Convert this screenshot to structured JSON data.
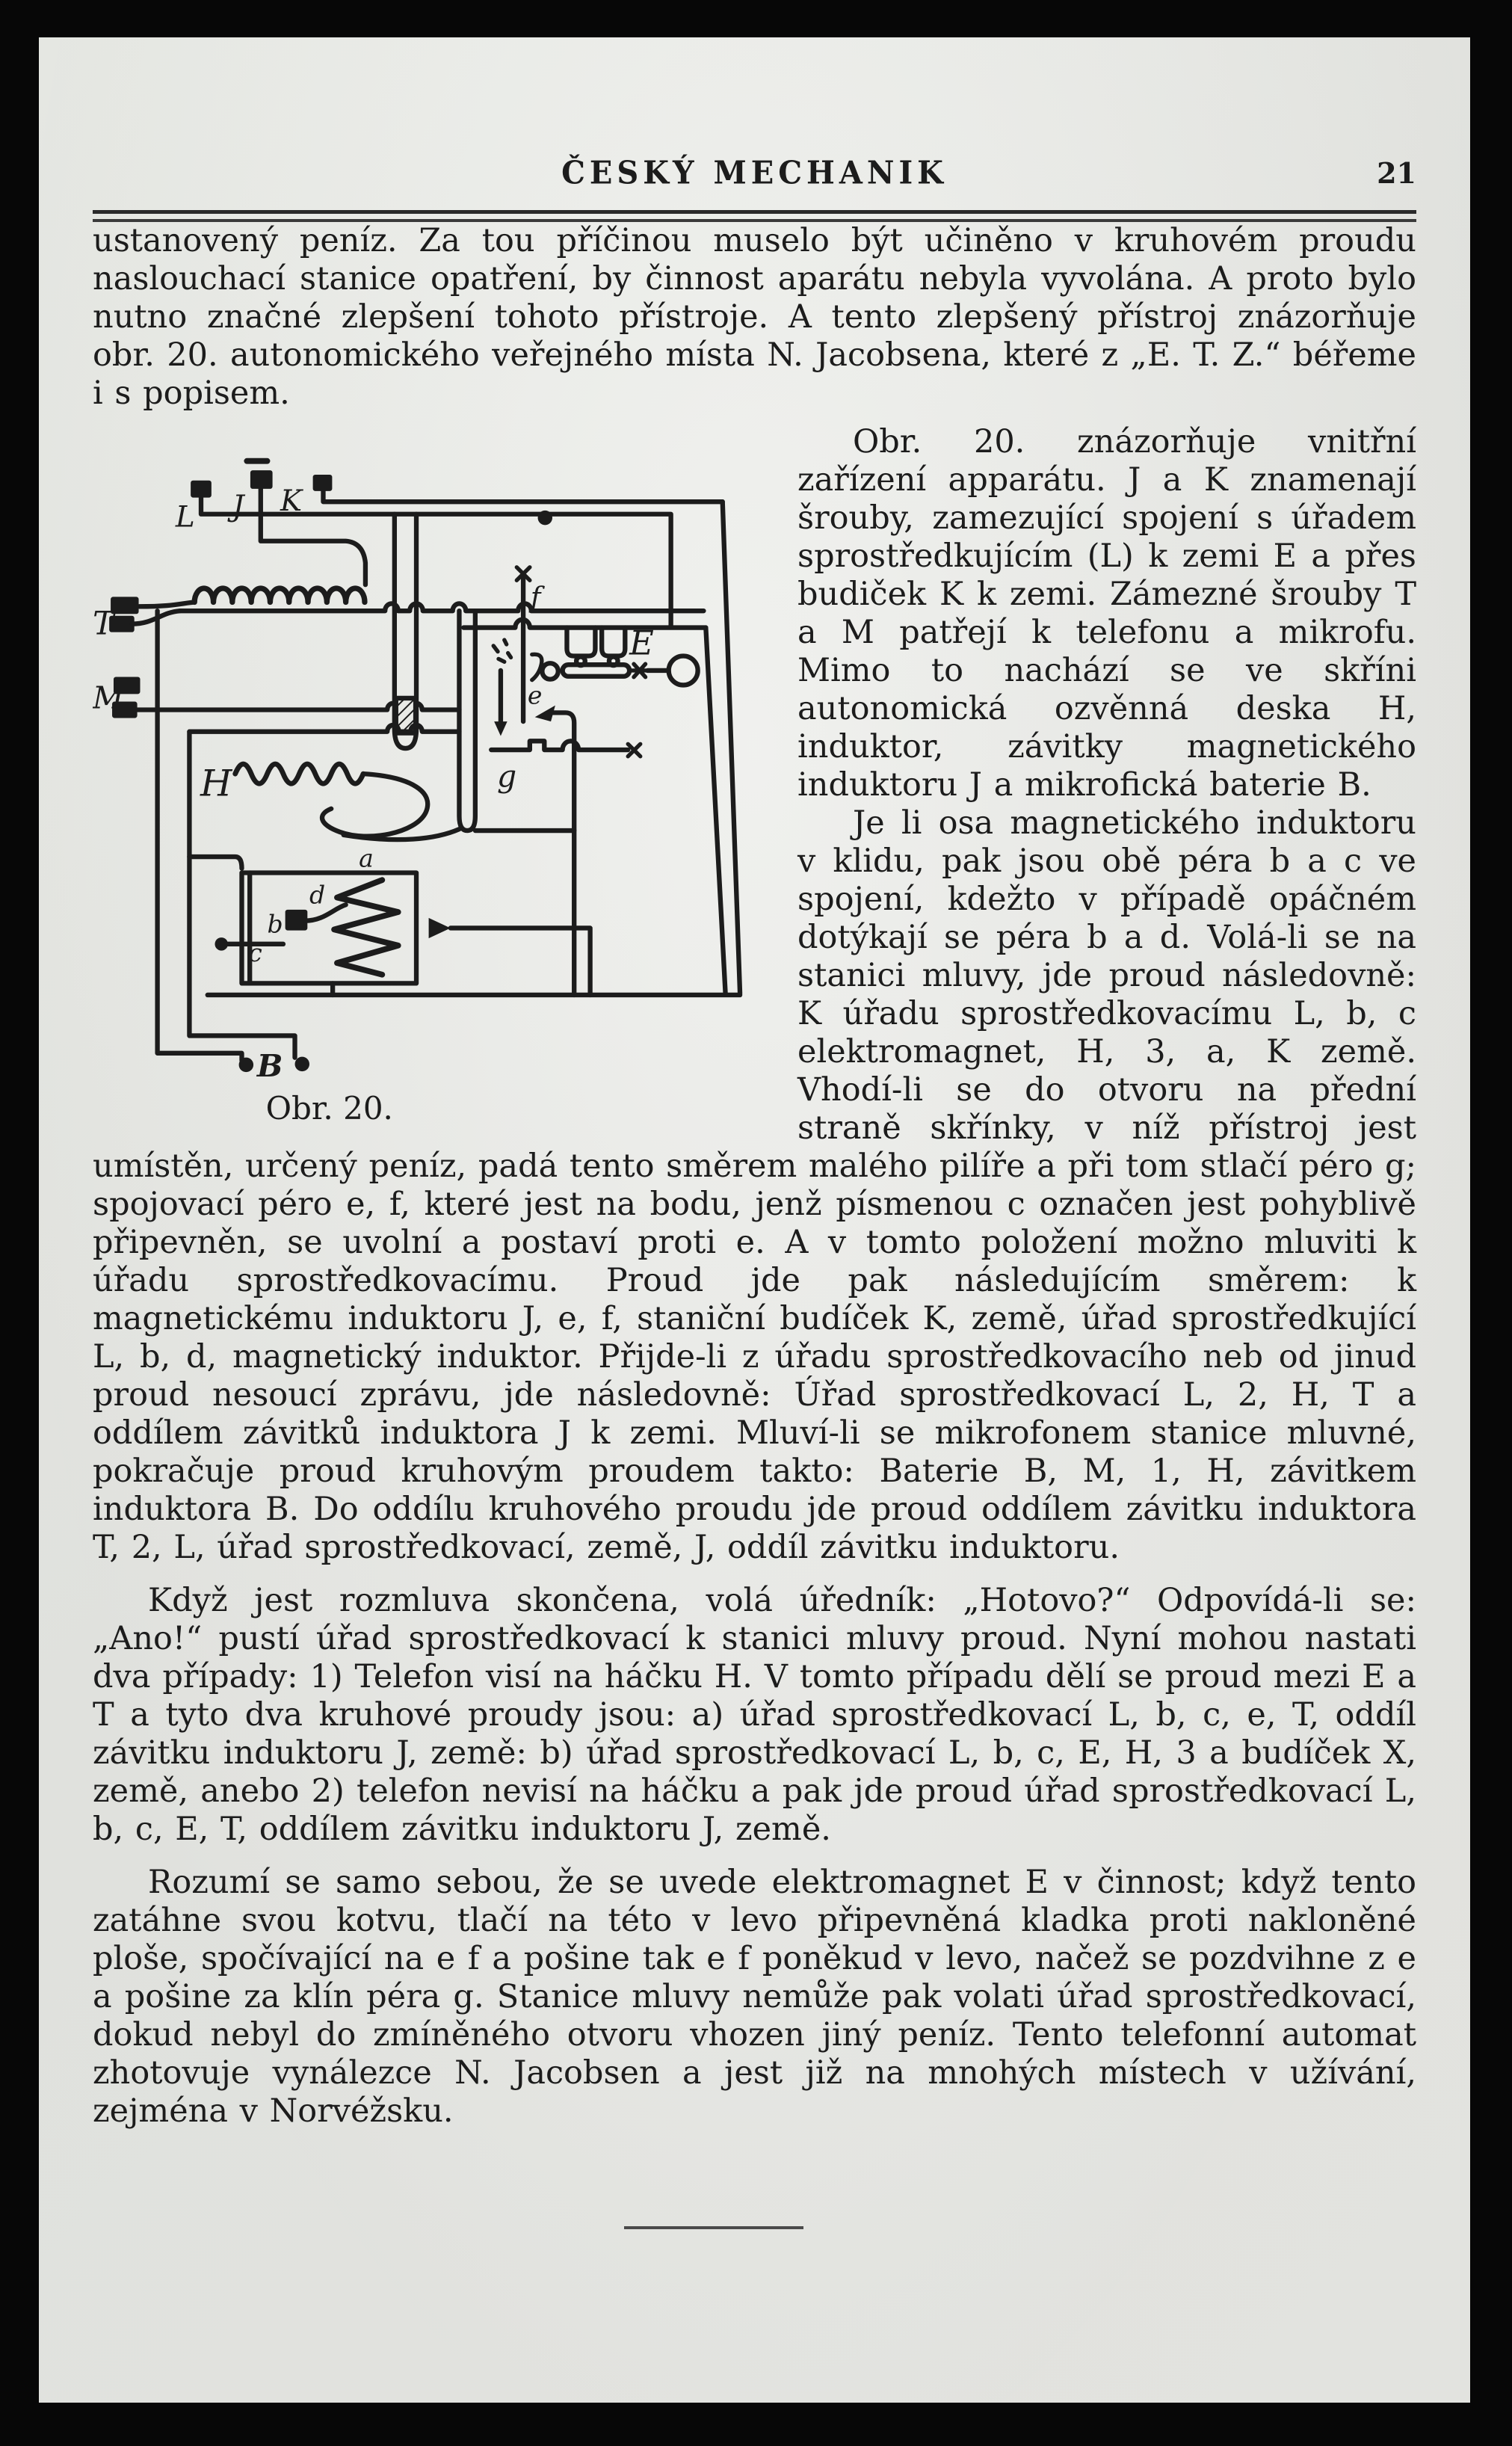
{
  "page": {
    "header": {
      "title": "ČESKÝ MECHANIK",
      "page_number": "21"
    },
    "colors": {
      "ink": "#1c1c1c",
      "paper": "#e9eae6",
      "border": "#070707"
    },
    "paragraphs": {
      "p1": "ustanovený peníz. Za tou příčinou muselo být učiněno v kruhovém proudu naslouchací stanice opatření, by činnost aparátu nebyla vyvolána. A proto bylo nutno značné zlepšení tohoto přístroje. A tento zlepšený přístroj znázorňuje obr. 20. autonomického veřejného místa N. Jacobsena, které z „E. T. Z.“ béřeme i s popisem.",
      "p2": "Obr. 20. znázorňuje vnitřní zařízení apparátu. J a K znamenají šrouby, zamezující spojení s úřadem sprostředkujícím (L) k zemi E a přes budiček K k zemi. Zámezné šrouby T a M patřejí k telefonu a mikrofu. Mimo to nachází se ve skříni autonomická ozvěnná deska H, induktor, závitky magnetického induktoru J a mikrofická baterie B.",
      "p3": "Je li osa magnetického induktoru v klidu, pak jsou obě péra b a c ve spojení, kdežto v případě opáčném dotýkají se péra b a d. Volá-li se na stanici mluvy, jde proud následovně: K úřadu sprostředkovacímu L, b, c elektromagnet, H, 3, a, K země. Vhodí-li se do otvoru na přední straně skřínky, v níž přístroj jest umístěn, určený peníz, padá tento směrem malého pilíře a při tom stlačí péro g; spojovací péro e, f, které jest na bodu, jenž písmenou c označen jest pohyblivě připevněn, se uvolní a postaví proti e. A v tomto položení možno mluviti k úřadu sprostředkovacímu. Proud jde pak následujícím směrem: k magnetickému induktoru J, e, f, staniční budíček K, země, úřad sprostředkující L, b, d, magnetický induktor. Přijde-li z úřadu sprostředkovacího neb od jinud proud nesoucí zprávu, jde následovně: Úřad sprostředkovací L, 2, H, T a oddílem závitků induktora J k zemi. Mluví-li se mikrofonem stanice mluvné, pokračuje proud kruhovým proudem takto: Baterie B, M, 1, H, závitkem induktora B. Do oddílu kruhového proudu jde proud oddílem závitku induktora T, 2, L, úřad sprostředkovací, země, J, oddíl závitku induktoru.",
      "p4": "Když jest rozmluva skončena, volá úředník: „Hotovo?“ Odpovídá-li se: „Ano!“ pustí úřad sprostředkovací k stanici mluvy proud. Nyní mohou nastati dva případy: 1) Telefon visí na háčku H. V tomto případu dělí se proud mezi E a T a tyto dva kruhové proudy jsou: a) úřad sprostředkovací L, b, c, e, T, oddíl závitku induktoru J, země: b) úřad sprostředkovací L, b, c, E, H, 3 a budíček X, země, anebo 2) telefon nevisí na háčku a pak jde proud úřad sprostředkovací L, b, c, E, T, oddílem závitku induktoru J, země.",
      "p5": "Rozumí se samo sebou, že se uvede elektromagnet E v činnost; když tento zatáhne svou kotvu, tlačí na této v levo připevněná kladka proti nakloněné ploše, spočívající na e f a pošine tak e f poněkud v levo, načež se pozdvihne z e a pošine za klín péra g. Stanice mluvy nemůže pak volati úřad sprostředkovací, dokud nebyl do zmíněného otvoru vhozen jiný peníz. Tento telefonní automat zhotovuje vynálezce N. Jacobsen a jest již na mnohých místech v užívání, zejména v Norvéžsku."
    },
    "figure": {
      "caption": "Obr. 20.",
      "labels": {
        "L": "L",
        "J": "J",
        "K": "K",
        "T": "T",
        "M": "M",
        "H": "H",
        "E": "E",
        "B": "B",
        "a": "a",
        "b": "b",
        "c": "c",
        "d": "d",
        "e": "e",
        "f": "f",
        "g": "g"
      }
    }
  }
}
